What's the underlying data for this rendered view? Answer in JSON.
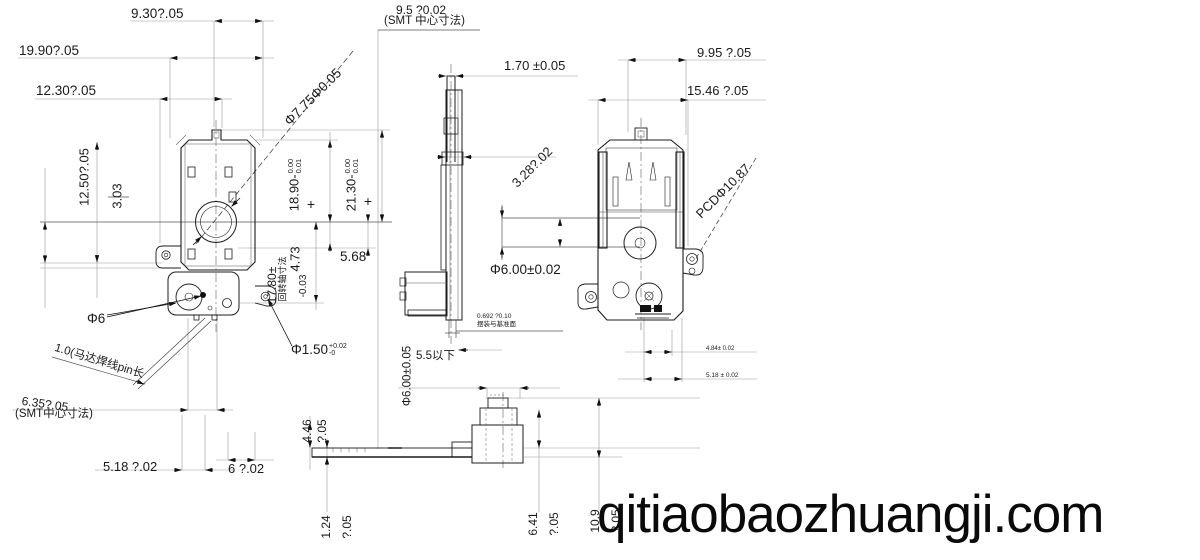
{
  "drawing": {
    "type": "engineering-drawing",
    "colors": {
      "background": "#ffffff",
      "line": "#1a1a1a",
      "thin_line": "#999999",
      "watermark": "#0a0a0a"
    }
  },
  "labels": {
    "d930": "9.30?.05",
    "d1990": "19.90?.05",
    "d1230": "12.30?.05",
    "d1250": "12.50?.05",
    "d303": "3.03",
    "phi775": "Φ7.75Φ0.05",
    "d95": "9.5 ?0.02",
    "smt1": "(SMT 中心寸法)",
    "d170": "1.70 ±0.05",
    "d328": "3.28?.02",
    "d995": "9.95 ?.05",
    "d1546": "15.46 ?.05",
    "pcd": "PCDΦ10.87",
    "d1890": "18.90-",
    "d1890t": "0.00",
    "d1890b": "0.01",
    "plus1": "+",
    "d2130": "21.30-",
    "d2130t": "0.00",
    "d2130b": "0.01",
    "plus2": "+",
    "d1780": "17.80±",
    "axis_note": "回转轴寸法",
    "d473": "4.73",
    "dm003": "-0.03",
    "d568": "5.68",
    "phi602": "Φ6.00±0.02",
    "run1": "0.692 ?0.10",
    "run2": "摆装与基准面",
    "d55": "5.5以下",
    "phi605": "Φ6.00±0.05",
    "phi6": "Φ6",
    "pin_note": "1.0(马达焊线pin长",
    "d635": "6.35?.05",
    "smt2": "(SMT中心寸法)",
    "d518": "5.18 ?.02",
    "d6": "6 ?.02",
    "phi150": "Φ1.50",
    "phi150t": "+0.02",
    "phi150b": "-0",
    "d446": "4.46",
    "q05a": "?.05",
    "d124": "1.24",
    "q05b": "?.05",
    "d641": "6.41",
    "q05c": "?.05",
    "d109": "10.9",
    "q05d": "?.05",
    "d484": "4.84± 0.02",
    "d518b": "5.18 ± 0.02"
  },
  "watermark": "qitiaobaozhuangji.com"
}
